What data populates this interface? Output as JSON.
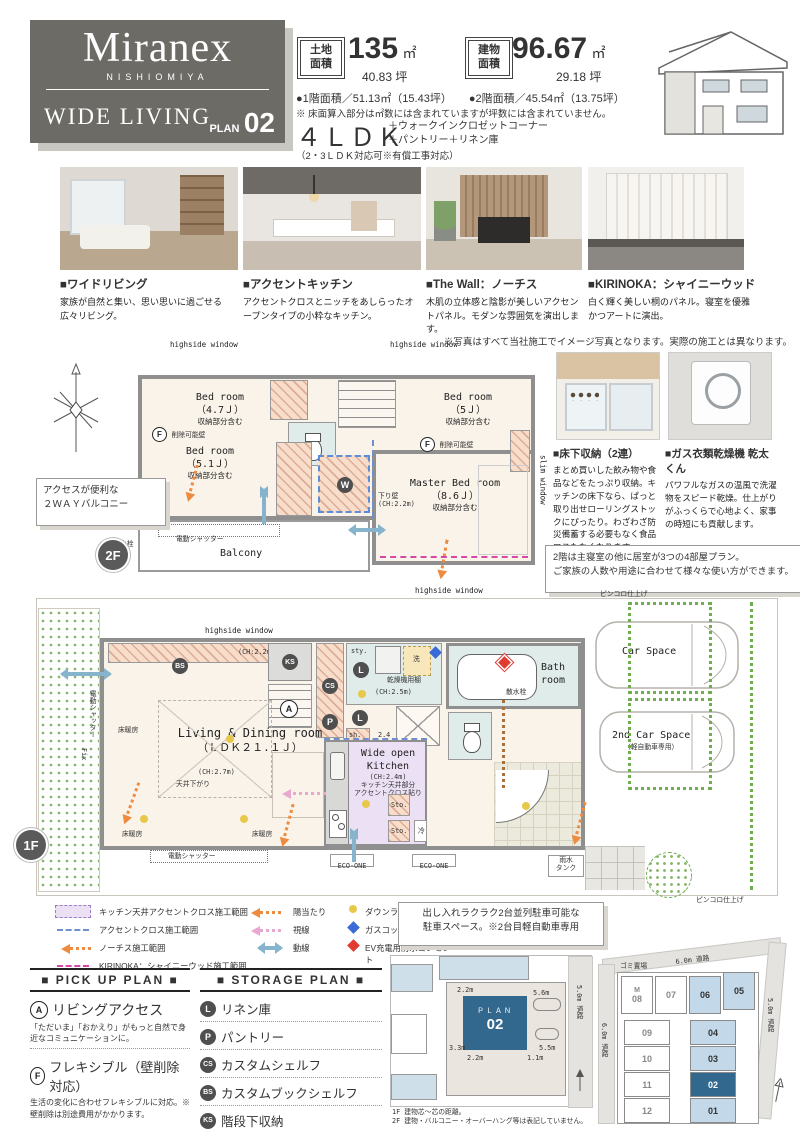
{
  "colors": {
    "logo_bg": "#6c6b66",
    "plan_blue": "#33688e",
    "lot_blue": "#c3d9ea",
    "green": "#6fae4e",
    "orange": "#ef8b3f",
    "pink": "#e9a8cf",
    "kitchen_purple": "#ece0f4"
  },
  "header": {
    "brand": "Miranex",
    "brand_sub": "NISHIOMIYA",
    "series": "WIDE LIVING",
    "plan_word": "PLAN",
    "plan_number": "02",
    "land_label": "土地面積",
    "land_value": "135",
    "land_unit": "㎡",
    "land_tsubo": "40.83 坪",
    "building_label": "建物面積",
    "building_value": "96.67",
    "building_unit": "㎡",
    "building_tsubo": "29.18 坪",
    "floor1_area": "●1階面積／51.13㎡（15.43坪）",
    "floor2_area": "●2階面積／45.54㎡（13.75坪）",
    "area_note": "※ 床面算入部分は㎡数には含まれていますが坪数には含まれていません。",
    "layout": "４ＬＤＫ",
    "layout_plus1": "＋ウォークインクロゼットコーナー",
    "layout_plus2": "＋パントリー＋リネン庫",
    "layout_note": "（2・3ＬＤＫ対応可※有償工事対応）"
  },
  "photos": [
    {
      "title": "■ワイドリビング",
      "desc": "家族が自然と集い、思い思いに過ごせる広々リビング。"
    },
    {
      "title": "■アクセントキッチン",
      "desc": "アクセントクロスとニッチをあしらったオープンタイプの小粋なキッチン。"
    },
    {
      "title": "■The Wall：ノーチス",
      "desc": "木肌の立体感と陰影が美しいアクセントパネル。モダンな雰囲気を演出します。"
    },
    {
      "title": "■KIRINOKA：シャイニーウッド",
      "desc": "白く輝く美しい桐のパネル。寝室を優雅かつアートに演出。"
    }
  ],
  "photo_note": "※写真はすべて当社施工でイメージ写真となります。実際の施工とは異なります。",
  "plan2f": {
    "badge": "2F",
    "hw1": "highside window",
    "hw2": "highside window",
    "hw3": "highside window",
    "slim": "slim window",
    "bed1_l1": "Bed room",
    "bed1_l2": "（4.7Ｊ）",
    "bed1_l3": "収納部分含む",
    "bed2_l1": "Bed room",
    "bed2_l2": "（5Ｊ）",
    "bed2_l3": "収納部分含む",
    "bed3_l1": "Bed room",
    "bed3_l2": "（5.1Ｊ）",
    "bed3_l3": "収納部分含む",
    "mbr_l1": "Master Bed room",
    "mbr_l2": "（8.6Ｊ）",
    "mbr_l3": "収納部分含む",
    "balcony": "Balcony",
    "shutter": "電動シャッター",
    "down_wall_l1": "下り壁",
    "down_wall_l2": "(CH:2.2m)",
    "removable": "削除可能壁",
    "f": "F",
    "w": "W",
    "faucet": "水栓",
    "note_l1": "アクセスが便利な",
    "note_l2": "２ＷＡＹバルコニー"
  },
  "features": [
    {
      "title": "■床下収納（2連）",
      "desc": "まとめ買いした飲み物や食品などをたっぷり収納。キッチンの床下なら、ぱっと取り出せローリングストックにぴったり。わざわざ防災備蓄する必要もなく食品ロスもなくなります。"
    },
    {
      "title": "■ガス衣類乾燥機 乾太くん",
      "desc": "パワフルなガスの温風で洗濯物をスピード乾燥。仕上がりがふっくらで心地よく、家事の時短にも貢献します。"
    }
  ],
  "plan2f_note_l1": "2階は主寝室の他に居室が3つの4部屋プラン。",
  "plan2f_note_l2": "ご家族の人数や用途に合わせて様々な使い方ができます。",
  "plan1f": {
    "badge": "1F",
    "hw": "highside window",
    "ch22": "(CH:2.2m)",
    "ch25": "(CH:2.5m)",
    "ch27": "(CH:2.7m)",
    "ldk_l1": "Living & Dining room",
    "ldk_l2": "（ＬＤＫ２１.１Ｊ）",
    "ceiling": "天井下がり",
    "heat": "床暖房",
    "kit_l1": "Wide open",
    "kit_l2": "Kitchen",
    "kit_l3": "(CH:2.4m)",
    "kit_l4": "キッチン天井部分",
    "kit_l5": "アクセントクロス貼り",
    "sto": "Sto.",
    "rei": "冷",
    "sen": "洗",
    "sty": "sty.",
    "sh": "sh.",
    "d24": "2.4",
    "dryer": "乾燥機用棚",
    "tv_l1": "ＴＶ",
    "tv_l2": "Phone",
    "bath_l1": "Bath",
    "bath_l2": "room",
    "eco": "ECO-ONE",
    "rain_l1": "雨水",
    "rain_l2": "タンク",
    "shutter": "電動シャッター",
    "fix": "Fix",
    "car1": "Car Space",
    "car2": "2nd Car Space",
    "car2n": "（軽自動車専用）",
    "sansui": "散水栓",
    "pinkoro": "ピンコロ仕上げ",
    "badges": {
      "a": "A",
      "p": "P",
      "l": "L",
      "cs": "CS",
      "bs": "BS",
      "ks": "KS",
      "w": "W"
    }
  },
  "legend": {
    "i1": "キッチン天井アクセントクロス施工範囲",
    "i2": "アクセントクロス施工範囲",
    "i3": "ノーチス施工範囲",
    "i4": "KIRINOKA：シャイニーウッド施工範囲",
    "i5": "陽当たり",
    "i6": "視線",
    "i7": "動線",
    "i8": "ダウンライト",
    "i9": "ガスコック",
    "i10": "EV充電用防水コンセント"
  },
  "pickup": {
    "title": "■ PICK UP PLAN ■",
    "a_badge": "A",
    "a_name": "リビングアクセス",
    "a_desc": "「ただいま」「おかえり」がもっと自然で身近なコミュニケーションに。",
    "f_badge": "F",
    "f_name": "フレキシブル（壁削除対応）",
    "f_desc": "生活の変化に合わせフレキシブルに対応。※壁削除は別途費用がかかります。"
  },
  "storage": {
    "title": "■ STORAGE PLAN ■",
    "items": [
      {
        "b": "L",
        "n": "リネン庫"
      },
      {
        "b": "P",
        "n": "パントリー"
      },
      {
        "b": "CS",
        "n": "カスタムシェルフ"
      },
      {
        "b": "BS",
        "n": "カスタムブックシェルフ"
      },
      {
        "b": "KS",
        "n": "階段下収納"
      },
      {
        "b": "W",
        "n": "ウォークインクロゼットコーナー"
      }
    ]
  },
  "parking_l1": "出し入れラクラク2台並列駐車可能な",
  "parking_l2": "駐車スペース。※2台目軽自動車専用",
  "siteplan": {
    "plan_w": "ＰＬＡＮ",
    "plan_n": "02",
    "d1": "2.2m",
    "d2": "3.3m",
    "d3": "2.2m",
    "d4": "1.1m",
    "d5": "5.6m",
    "d6": "5.5m",
    "road": "5.0m 道路",
    "note1": "1F 建物芯～芯の距離。",
    "note2": "2F 建物・バルコニー・オーバーハング等は表記していません。"
  },
  "lotmap": {
    "road_top": "6.0m 道路",
    "road_left": "6.0m 道路",
    "road_right": "5.0m 道路",
    "trash": "ゴミ置場",
    "m": "M",
    "lots": [
      "08",
      "07",
      "06",
      "05",
      "09",
      "04",
      "10",
      "03",
      "11",
      "02",
      "12",
      "01"
    ]
  }
}
